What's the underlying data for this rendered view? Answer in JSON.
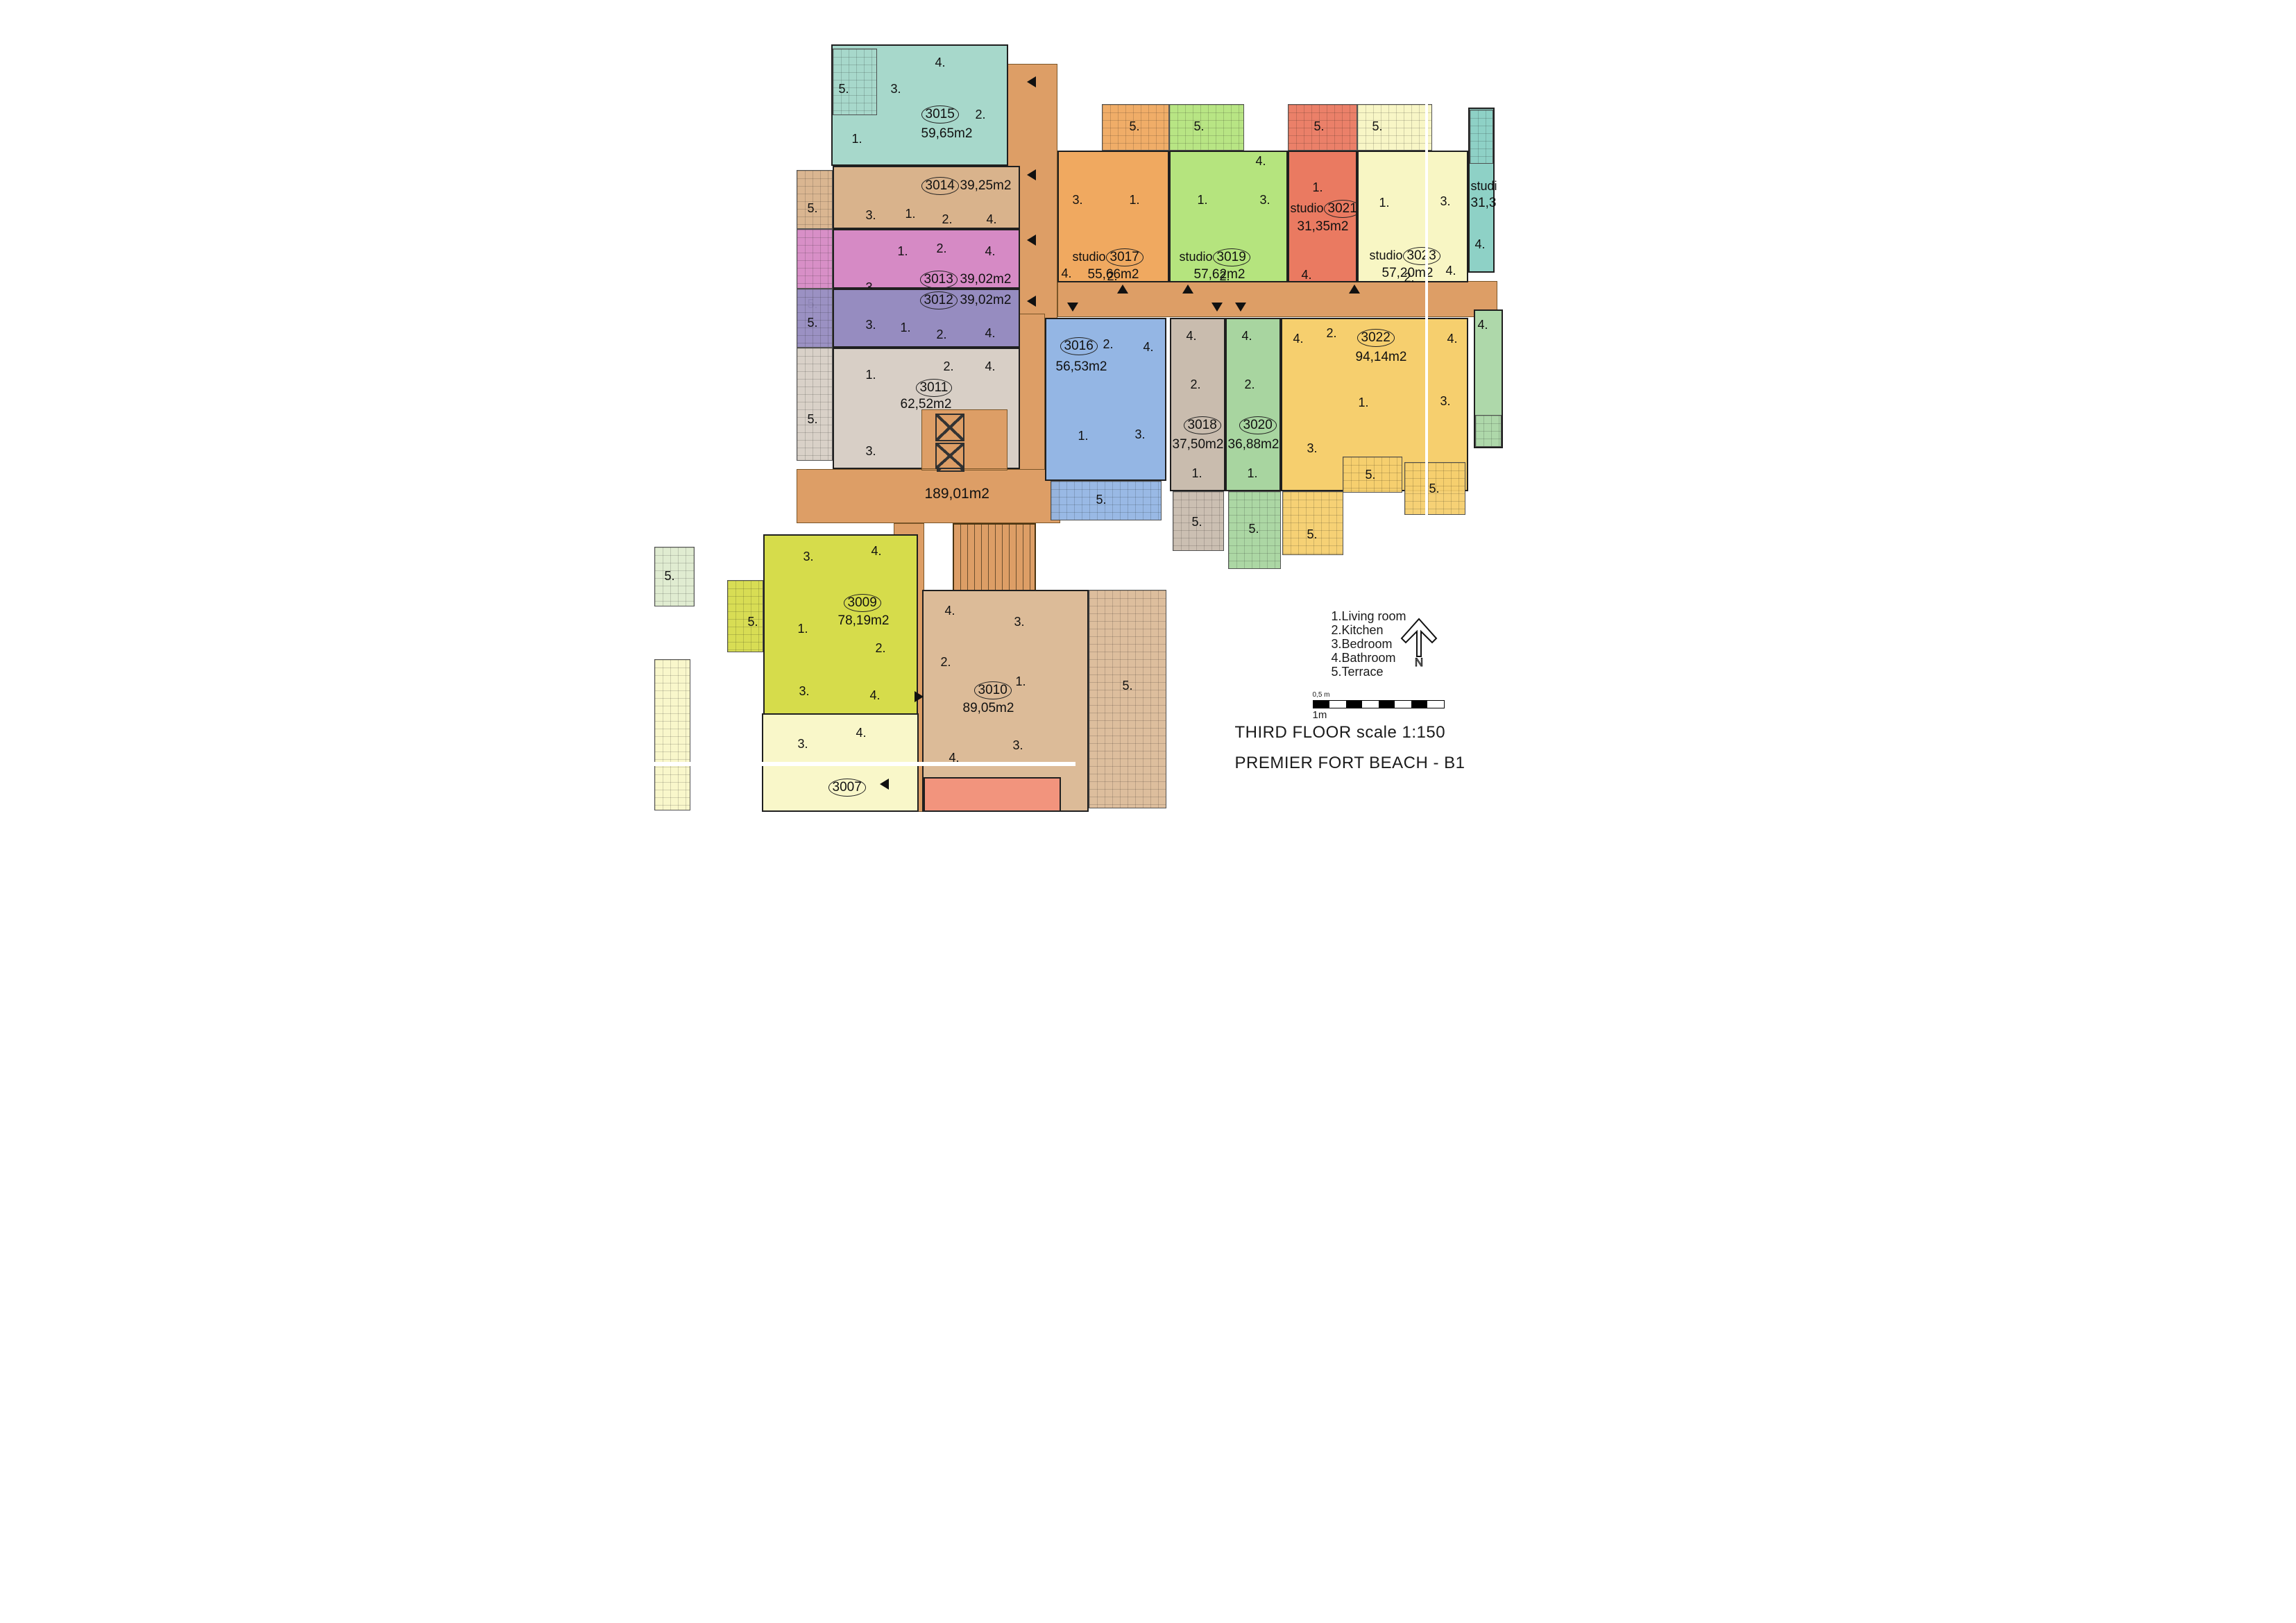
{
  "titles": {
    "floor": "THIRD FLOOR scale 1:150",
    "project": "PREMIER FORT BEACH - B1"
  },
  "legend": [
    "1.Living room",
    "2.Kitchen",
    "3.Bedroom",
    "4.Bathroom",
    "5.Terrace"
  ],
  "north_label": "N",
  "scalebar": {
    "top": "0,5 m",
    "bottom": "1m"
  },
  "corridor_area": "189,01m2",
  "rooms": {
    "r1": "1.",
    "r2": "2.",
    "r3": "3.",
    "r4": "4.",
    "r5": "5."
  },
  "units": [
    {
      "num": "3015",
      "area": "59,65m2"
    },
    {
      "num": "3014",
      "area": "39,25m2"
    },
    {
      "num": "3013",
      "area": "39,02m2"
    },
    {
      "num": "3012",
      "area": "39,02m2"
    },
    {
      "num": "3011",
      "area": "62,52m2"
    },
    {
      "prefix": "studio",
      "num": "3017",
      "area": "55,66m2"
    },
    {
      "prefix": "studio",
      "num": "3019",
      "area": "57,62m2"
    },
    {
      "prefix": "studio",
      "num": "3021",
      "area": "31,35m2"
    },
    {
      "prefix": "studio",
      "num": "3023",
      "area": "57,20m2"
    },
    {
      "prefix": "studi",
      "area": "31,3"
    },
    {
      "num": "3016",
      "area": "56,53m2"
    },
    {
      "num": "3018",
      "area": "37,50m2"
    },
    {
      "num": "3020",
      "area": "36,88m2"
    },
    {
      "num": "3022",
      "area": "94,14m2"
    },
    {
      "num": "3009",
      "area": "78,19m2"
    },
    {
      "num": "3010",
      "area": "89,05m2"
    },
    {
      "num": "3007"
    }
  ],
  "colors": {
    "corridor": "#dd9e66",
    "u3015": "#a7d8cb",
    "u3014": "#d9b38c",
    "u3013": "#d68ac5",
    "u3012": "#968cc0",
    "u3011": "#d8cfc6",
    "u3017": "#f0a960",
    "u3019": "#b5e47e",
    "u3021": "#ea7a61",
    "u3023": "#f8f6c4",
    "u3025": "#8ed1c6",
    "u3016": "#94b6e4",
    "u3018": "#c9bcae",
    "u3020": "#a8d5a0",
    "u3022": "#f6cf6e",
    "right_green": "#aed8aa",
    "u3009": "#d6dc4b",
    "u3010": "#dcbb98",
    "u3007": "#f9f7c9",
    "salmon": "#f2947d",
    "terrace_pale_green": "#dfeccf"
  }
}
